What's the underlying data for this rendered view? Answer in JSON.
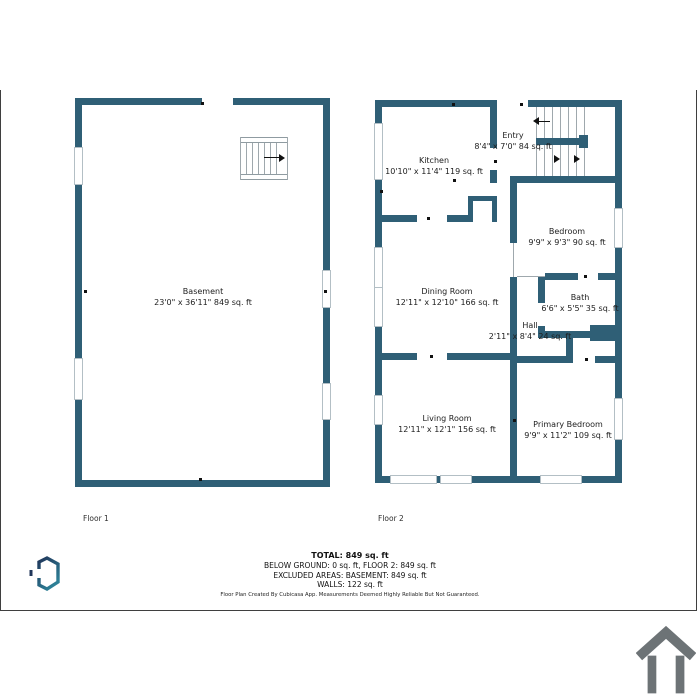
{
  "palette": {
    "wall_color": "#2f5f76",
    "page_border_color": "#3f3f3f",
    "house_icon_color": "#6d7376",
    "logo_gradient_start": "#20365a",
    "logo_gradient_end": "#2d8097"
  },
  "floors": [
    {
      "label": "Floor 1",
      "rooms": [
        {
          "name": "Basement",
          "dims": "23'0\" x 36'11\" 849 sq. ft"
        }
      ]
    },
    {
      "label": "Floor 2",
      "rooms": [
        {
          "name": "Kitchen",
          "dims": "10'10\" x 11'4\" 119 sq. ft"
        },
        {
          "name": "Entry",
          "dims": "8'4\" x 7'0\" 84 sq. ft"
        },
        {
          "name": "Bedroom",
          "dims": "9'9\" x 9'3\" 90 sq. ft"
        },
        {
          "name": "Dining Room",
          "dims": "12'11\" x 12'10\" 166 sq. ft"
        },
        {
          "name": "Bath",
          "dims": "6'6\" x 5'5\" 35 sq. ft"
        },
        {
          "name": "Hall",
          "dims": "2'11\" x 8'4\" 24 sq. ft"
        },
        {
          "name": "Living Room",
          "dims": "12'11\" x 12'1\" 156 sq. ft"
        },
        {
          "name": "Primary Bedroom",
          "dims": "9'9\" x 11'2\" 109 sq. ft"
        }
      ]
    }
  ],
  "summary": {
    "total": "TOTAL: 849 sq. ft",
    "below_ground": "BELOW GROUND: 0 sq. ft, FLOOR 2: 849 sq. ft",
    "excluded": "EXCLUDED AREAS: BASEMENT: 849 sq. ft",
    "walls": "WALLS: 122 sq. ft",
    "disclaimer": "Floor Plan Created By Cubicasa App. Measurements Deemed Highly Reliable But Not Guaranteed."
  }
}
